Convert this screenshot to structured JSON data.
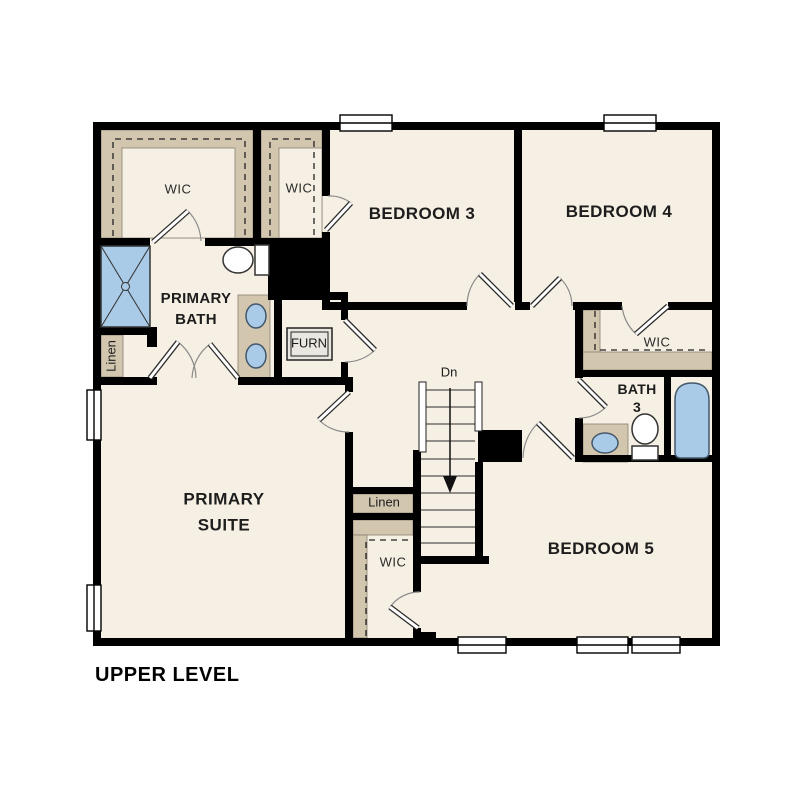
{
  "floor_plan": {
    "title": "UPPER LEVEL",
    "rooms": {
      "bedroom3": {
        "label": "BEDROOM 3"
      },
      "bedroom4": {
        "label": "BEDROOM 4"
      },
      "bedroom5": {
        "label": "BEDROOM 5"
      },
      "primary_suite": {
        "line1": "PRIMARY",
        "line2": "SUITE"
      },
      "primary_bath": {
        "line1": "PRIMARY",
        "line2": "BATH"
      },
      "bath3": {
        "line1": "BATH",
        "line2": "3"
      },
      "wic_primary": {
        "label": "WIC"
      },
      "wic_bedroom3": {
        "label": "WIC"
      },
      "wic_bedroom4": {
        "label": "WIC"
      },
      "wic_bedroom5": {
        "label": "WIC"
      },
      "linen_bath": {
        "label": "Linen"
      },
      "linen_hall": {
        "label": "Linen"
      },
      "furnace": {
        "label": "FURN"
      }
    },
    "stairs": {
      "label": "Dn",
      "direction": "down"
    },
    "colors": {
      "background": "#ffffff",
      "wall": "#000000",
      "floor": "#f6efe3",
      "closet_shelving": "#d2c6af",
      "fixture_blue": "#a9cbe8"
    }
  }
}
